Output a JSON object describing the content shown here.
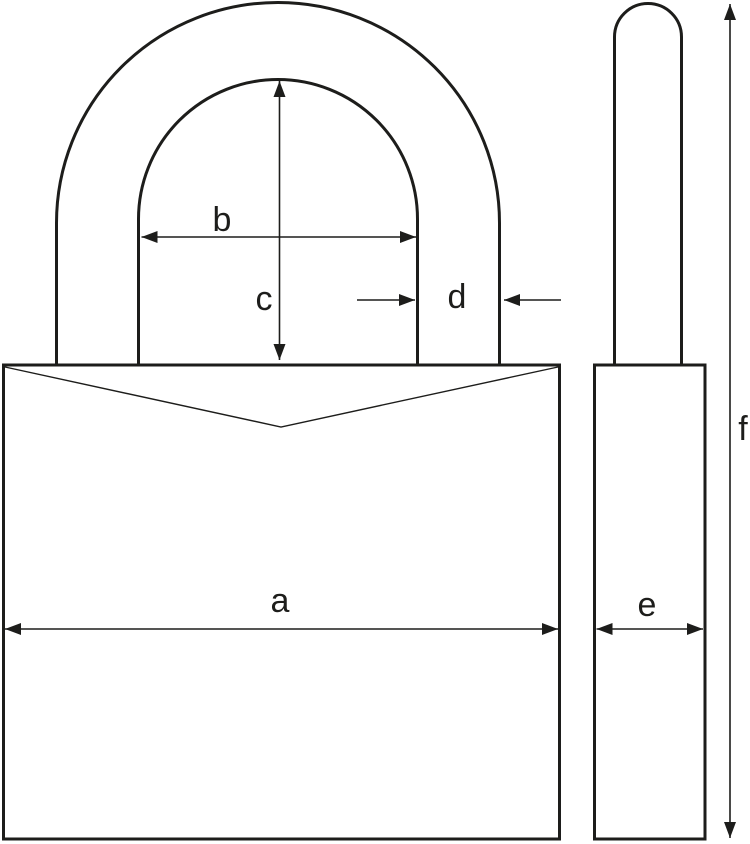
{
  "labels": {
    "a": "a",
    "b": "b",
    "c": "c",
    "d": "d",
    "e": "e",
    "f": "f"
  },
  "colors": {
    "line": "#1d1d1b",
    "background": "#ffffff"
  }
}
